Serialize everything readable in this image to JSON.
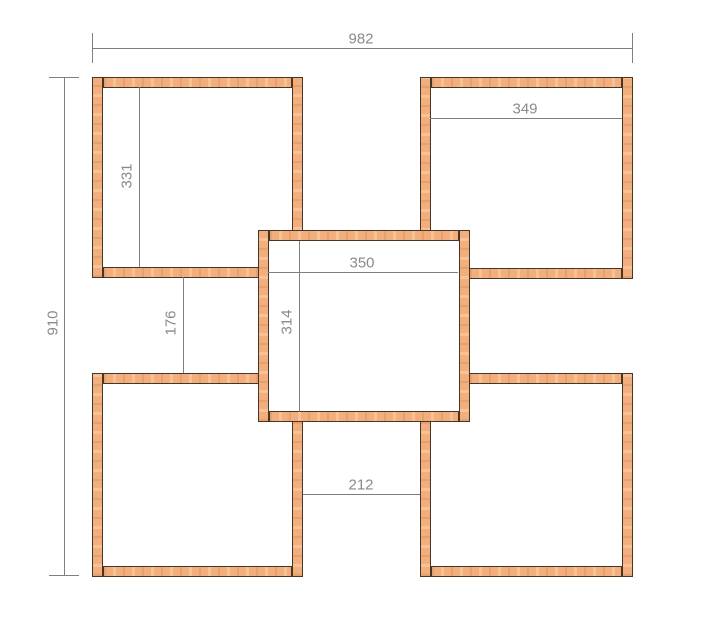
{
  "page": {
    "background_color": "#ffffff",
    "description": "Dimensioned plan drawing of five wooden square shelf frames"
  },
  "drawing": {
    "wood_style": {
      "fill_color": "#f2ae7c",
      "edge_color": "#473526",
      "strip_thickness": 11
    },
    "dim_style": {
      "line_color": "#7f7f7f",
      "text_color": "#8a8a8a",
      "font_size_px": 15,
      "end_tick_length": 30
    },
    "squares": [
      {
        "name": "top-left-box",
        "x": 92,
        "y": 77,
        "w": 211,
        "h": 201,
        "layer": 1,
        "fill": "none"
      },
      {
        "name": "top-right-box",
        "x": 420,
        "y": 77,
        "w": 213,
        "h": 202,
        "layer": 1,
        "fill": "none"
      },
      {
        "name": "bottom-left-box",
        "x": 92,
        "y": 373,
        "w": 211,
        "h": 204,
        "layer": 1,
        "fill": "none"
      },
      {
        "name": "bottom-right-box",
        "x": 420,
        "y": 373,
        "w": 213,
        "h": 204,
        "layer": 1,
        "fill": "none"
      },
      {
        "name": "center-box",
        "x": 258,
        "y": 230,
        "w": 212,
        "h": 192,
        "layer": 2,
        "fill": "#ffffff"
      }
    ],
    "dimensions": [
      {
        "label": "982",
        "orient": "h",
        "x1": 92,
        "x2": 632,
        "y": 48,
        "ticks": true,
        "label_x": 361,
        "label_y": 39,
        "layer": 1
      },
      {
        "label": "910",
        "orient": "v",
        "y1": 77,
        "y2": 575,
        "x": 64,
        "ticks": true,
        "label_x": 53,
        "label_y": 323,
        "layer": 1
      },
      {
        "label": "349",
        "orient": "h",
        "x1": 430,
        "x2": 622,
        "y": 118,
        "ticks": false,
        "label_x": 525,
        "label_y": 109,
        "layer": 1
      },
      {
        "label": "331",
        "orient": "v",
        "y1": 87,
        "y2": 267,
        "x": 139,
        "ticks": false,
        "label_x": 127,
        "label_y": 176,
        "layer": 1
      },
      {
        "label": "350",
        "orient": "h",
        "x1": 268,
        "x2": 458,
        "y": 272,
        "ticks": false,
        "label_x": 362,
        "label_y": 263,
        "layer": 3
      },
      {
        "label": "314",
        "orient": "v",
        "y1": 241,
        "y2": 412,
        "x": 299,
        "ticks": false,
        "label_x": 287,
        "label_y": 322,
        "layer": 3
      },
      {
        "label": "176",
        "orient": "v",
        "y1": 277,
        "y2": 373,
        "x": 183,
        "ticks": false,
        "label_x": 171,
        "label_y": 323,
        "layer": 1
      },
      {
        "label": "212",
        "orient": "h",
        "x1": 303,
        "x2": 420,
        "y": 494,
        "ticks": false,
        "label_x": 361,
        "label_y": 485,
        "layer": 1
      }
    ]
  }
}
